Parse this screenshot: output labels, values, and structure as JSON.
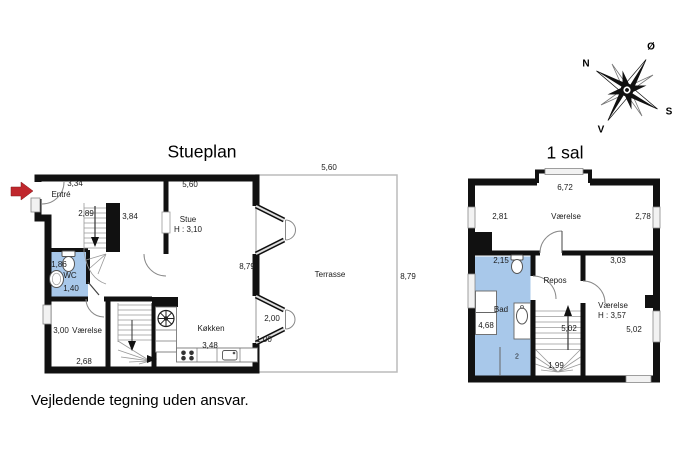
{
  "footer_disclaimer": "Vejledende tegning uden ansvar.",
  "compass": {
    "north": "N",
    "east": "Ø",
    "south": "S",
    "west": "V"
  },
  "colors": {
    "wall": "#111111",
    "wet_room_blue": "#a8c8ea",
    "terrasse_outline": "#bbbbbb",
    "entrance_arrow_red": "#c0272d"
  },
  "stueplan": {
    "title": "Stueplan",
    "rooms": {
      "entre": "Entré",
      "stue": "Stue",
      "stue_height": "H : 3,10",
      "wc": "WC",
      "vaerelse": "Værelse",
      "koekken": "Køkken",
      "terrasse": "Terrasse"
    },
    "dims": {
      "d334": "3,34",
      "d560_top": "5,60",
      "d560_terrasse": "5,60",
      "d289": "2,89",
      "d384": "3,84",
      "d879_inner": "8,79",
      "d879_terrasse": "8,79",
      "d186": "1,86",
      "d140": "1,40",
      "d300": "3,00",
      "d268": "2,68",
      "d348": "3,48",
      "d200": "2,00",
      "d100": "1,00"
    }
  },
  "first_floor": {
    "title": "1 sal",
    "rooms": {
      "vaerelse_top": "Værelse",
      "repos": "Repos",
      "bad": "Bad",
      "vaerelse_right": "Værelse",
      "vaerelse_right_height": "H : 3,57"
    },
    "dims": {
      "d672": "6,72",
      "d281": "2,81",
      "d278": "2,78",
      "d215": "2,15",
      "d303": "3,03",
      "d468": "4,68",
      "d502_stairs": "5,02",
      "d502_right": "5,02",
      "d199": "1,99",
      "d2_partial": "2"
    }
  }
}
